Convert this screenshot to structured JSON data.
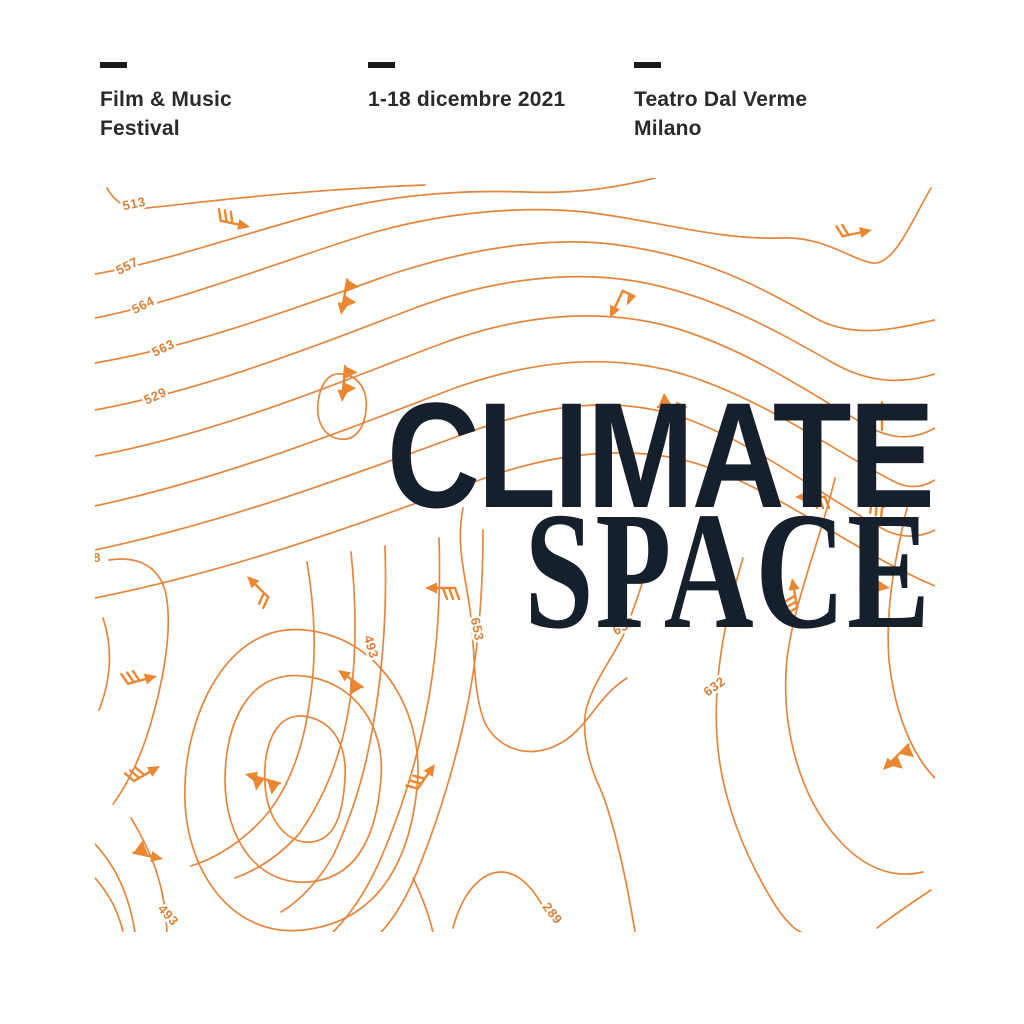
{
  "palette": {
    "background": "#ffffff",
    "contour_orange": "#E6863D",
    "label_orange": "#DD8038",
    "barb_orange": "#EA8730",
    "title_ink": "#16202C",
    "header_ink": "#2a2a2a",
    "dash_ink": "#1b1b1b"
  },
  "header": {
    "columns": [
      {
        "line1": "Film & Music",
        "line2": "Festival"
      },
      {
        "line1": "1-18 dicembre 2021",
        "line2": ""
      },
      {
        "line1": "Teatro Dal Verme",
        "line2": "Milano"
      }
    ]
  },
  "title": {
    "line1": "CLIMATE",
    "line2": "SPACE"
  },
  "map": {
    "description": "orange isoline weather map with wind barbs",
    "contour_labels": [
      {
        "value": "513",
        "x": 40,
        "y": 30,
        "rotation": -12
      },
      {
        "value": "557",
        "x": 34,
        "y": 92,
        "rotation": -26
      },
      {
        "value": "564",
        "x": 50,
        "y": 131,
        "rotation": -27
      },
      {
        "value": "563",
        "x": 70,
        "y": 174,
        "rotation": -25
      },
      {
        "value": "529",
        "x": 62,
        "y": 222,
        "rotation": -24
      },
      {
        "value": "8",
        "x": 2,
        "y": 384,
        "rotation": 0
      },
      {
        "value": "493",
        "x": 272,
        "y": 470,
        "rotation": 74
      },
      {
        "value": "493",
        "x": 70,
        "y": 740,
        "rotation": 48
      },
      {
        "value": "653",
        "x": 378,
        "y": 452,
        "rotation": 78
      },
      {
        "value": "632",
        "x": 531,
        "y": 452,
        "rotation": -28
      },
      {
        "value": "632",
        "x": 622,
        "y": 512,
        "rotation": -36
      },
      {
        "value": "289",
        "x": 454,
        "y": 738,
        "rotation": 52
      }
    ],
    "wind_barbs": [
      {
        "x": 155,
        "y": 49,
        "rotation": 12,
        "type": "feather3"
      },
      {
        "x": 515,
        "y": 140,
        "rotation": 115,
        "type": "flag"
      },
      {
        "x": 777,
        "y": 52,
        "rotation": -12,
        "type": "feather2"
      },
      {
        "x": 246,
        "y": 137,
        "rotation": 100,
        "type": "pennant2"
      },
      {
        "x": 247,
        "y": 224,
        "rotation": 95,
        "type": "pennant2"
      },
      {
        "x": 593,
        "y": 229,
        "rotation": 0,
        "type": "pennant"
      },
      {
        "x": 787,
        "y": 222,
        "rotation": -90,
        "type": "plain"
      },
      {
        "x": 700,
        "y": 319,
        "rotation": 180,
        "type": "feather3"
      },
      {
        "x": 789,
        "y": 329,
        "rotation": -155,
        "type": "ticks"
      },
      {
        "x": 697,
        "y": 400,
        "rotation": -100,
        "type": "feather3"
      },
      {
        "x": 795,
        "y": 410,
        "rotation": 8,
        "type": "pennant"
      },
      {
        "x": 330,
        "y": 410,
        "rotation": 180,
        "type": "feather3"
      },
      {
        "x": 152,
        "y": 398,
        "rotation": -135,
        "type": "feather2"
      },
      {
        "x": 340,
        "y": 586,
        "rotation": -55,
        "type": "feather3"
      },
      {
        "x": 62,
        "y": 498,
        "rotation": -15,
        "type": "feather3"
      },
      {
        "x": 65,
        "y": 588,
        "rotation": -30,
        "type": "feather3"
      },
      {
        "x": 150,
        "y": 596,
        "rotation": 195,
        "type": "pennant2"
      },
      {
        "x": 68,
        "y": 681,
        "rotation": 12,
        "type": "pennant"
      },
      {
        "x": 243,
        "y": 492,
        "rotation": -145,
        "type": "pennant"
      },
      {
        "x": 788,
        "y": 592,
        "rotation": 135,
        "type": "pennant2"
      }
    ],
    "contours": [
      "M 12,10 C 22,28 36,32 52,30 C 110,24 200,12 330,7",
      "M 0,96 C 70,84 150,55 230,34 C 300,16 370,12 430,14 C 480,16 520,10 560,0",
      "M 0,140 C 90,122 180,85 270,57 C 350,33 430,28 490,34 C 560,42 620,62 685,60 C 730,58 756,82 778,85 C 800,87 818,40 836,10",
      "M 0,185 C 100,168 200,130 300,95 C 390,66 470,58 530,68 C 610,80 660,106 720,140 C 760,162 802,150 840,142",
      "M 0,232 C 110,212 220,168 320,130 C 400,100 480,92 545,104 C 620,118 680,152 740,186 C 780,208 814,204 840,196",
      "M 0,278 C 120,256 240,206 340,168 C 430,134 510,130 580,150 C 660,174 720,220 780,252 C 806,264 826,258 840,250",
      "M 0,328 C 130,300 250,252 360,210 C 450,178 530,176 600,200 C 680,228 740,274 800,304 C 816,312 830,308 840,302",
      "M 0,372 C 140,342 270,292 380,252 C 470,220 540,220 600,244 C 670,272 730,320 790,352 C 810,362 828,358 840,352",
      "M 0,420 C 150,390 280,340 390,300 C 480,268 560,268 620,292 C 700,324 764,376 840,408",
      "M 14,382 C 40,378 62,386 70,412 C 78,444 70,492 60,530 C 52,562 40,596 18,626",
      "M 212,384 C 220,432 222,482 214,528 C 208,568 196,606 172,636 C 150,662 122,680 96,688",
      "M 256,374 C 262,432 262,488 252,540 C 244,582 228,622 204,656 C 184,678 162,692 140,700",
      "M 290,368 C 292,430 288,492 278,548 C 270,596 256,640 238,678 C 224,702 206,722 186,734",
      "M 344,360 C 346,420 342,482 330,540 C 320,590 304,638 286,680 C 272,712 256,736 238,754",
      "M 388,352 C 388,420 382,488 368,548 C 356,600 340,650 322,694 C 308,728 294,746 286,754",
      "M 368,330 C 360,370 372,402 376,440 C 380,476 378,510 388,540 C 398,568 430,582 460,568 C 492,554 500,520 532,500",
      "M 560,370 C 548,400 540,430 528,458 C 516,482 500,502 492,528 C 486,550 492,582 504,608 C 516,634 530,692 540,754",
      "M 648,380 C 630,440 618,500 622,560 C 626,620 650,680 682,730 C 692,744 700,752 706,754",
      "M 740,300 C 726,360 700,420 692,480 C 686,540 700,612 742,660 C 772,694 802,700 828,694",
      "M 812,330 C 800,380 790,432 794,482 C 800,540 820,580 840,600",
      "M 208,538 C 240,542 252,570 250,600 C 248,636 240,662 216,664 C 190,666 172,640 170,606 C 168,572 178,536 208,538 Z",
      "M 208,498 C 262,504 290,550 286,600 C 282,654 264,700 214,704 C 162,708 130,660 130,602 C 130,548 152,492 208,498 Z",
      "M 210,452 C 290,460 330,540 322,610 C 314,688 280,744 208,752 C 136,760 86,690 90,606 C 92,540 130,444 210,452 Z",
      "M 8,440 C 18,470 16,502 4,532",
      "M 0,666 C 22,690 34,718 40,754",
      "M 0,700 C 16,718 24,736 28,754",
      "M 36,640 C 60,680 70,712 72,754",
      "M 318,700 C 328,720 334,738 338,754",
      "M 358,750 C 368,712 388,694 406,694 C 424,694 438,710 450,732",
      "M 782,750 C 800,736 818,724 836,712",
      "M 247,196 C 265,198 273,214 271,232 C 269,252 259,263 245,261 C 229,259 221,243 223,225 C 225,207 233,194 247,196 Z"
    ]
  }
}
